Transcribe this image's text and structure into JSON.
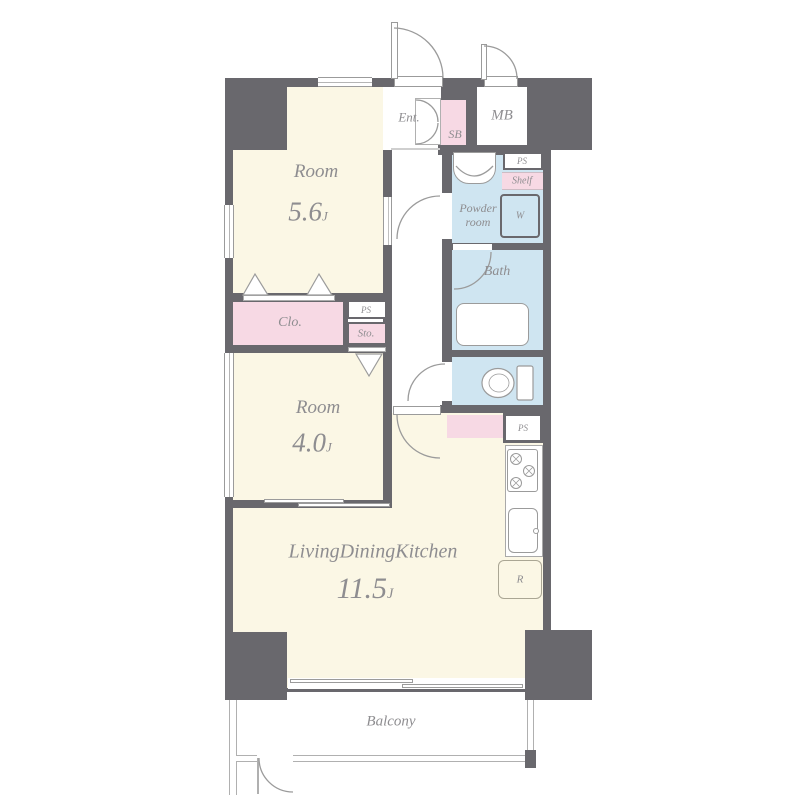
{
  "title": "apartment-floor-plan",
  "colors": {
    "wall": "#69686d",
    "floor": "#fbf7e5",
    "pink": "#f7d9e4",
    "blue": "#cfe5f1"
  },
  "rooms": {
    "bedroom1": {
      "label": "Room",
      "size": "5.6",
      "unit": "J"
    },
    "bedroom2": {
      "label": "Room",
      "size": "4.0",
      "unit": "J"
    },
    "ldk": {
      "label": "LivingDiningKitchen",
      "size": "11.5",
      "unit": "J"
    }
  },
  "labels": {
    "entrance": "Ent.",
    "shoe_box": "SB",
    "meter_box": "MB",
    "pipe_shaft": "PS",
    "shelf": "Shelf",
    "washing_machine": "W",
    "powder_room": "Powder room",
    "bath": "Bath",
    "closet": "Clo.",
    "storage": "Sto.",
    "refrigerator": "R",
    "balcony": "Balcony"
  }
}
